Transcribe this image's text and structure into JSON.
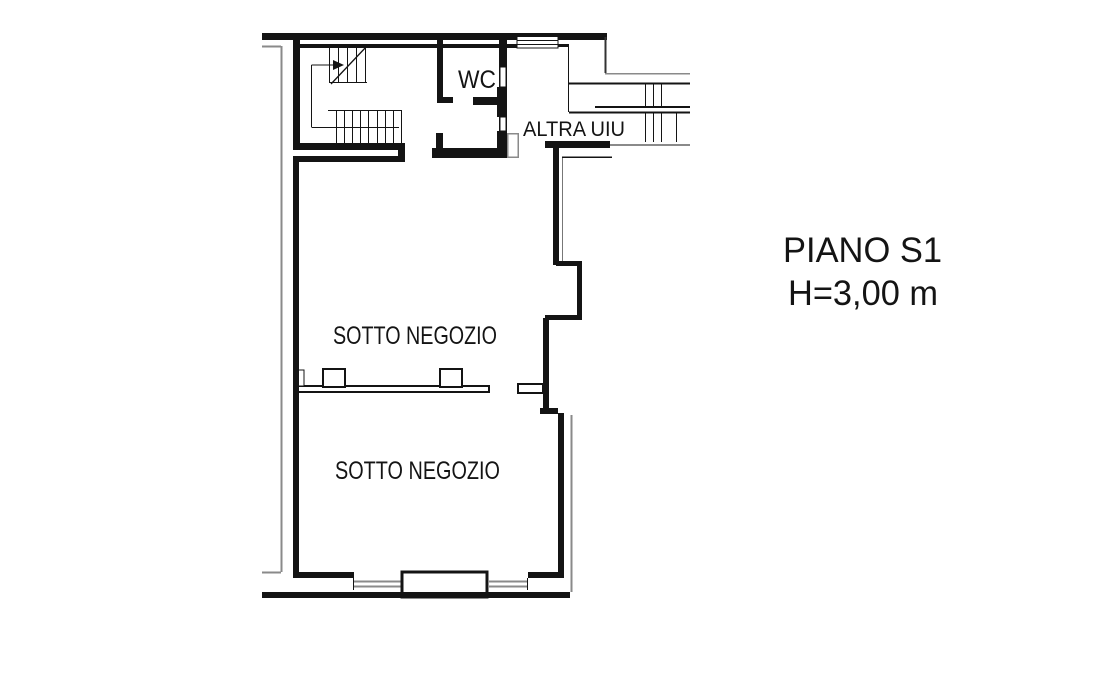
{
  "plan": {
    "labels": {
      "wc": "WC",
      "altra_uiu": "ALTRA UIU",
      "sotto_negozio_upper": "SOTTO NEGOZIO",
      "sotto_negozio_lower": "SOTTO NEGOZIO"
    },
    "annotation": {
      "floor": "PIANO S1",
      "height": "H=3,00 m"
    },
    "colors": {
      "wall": "#141414",
      "secondary_line": "#8a8a8a",
      "background": "#ffffff"
    }
  }
}
